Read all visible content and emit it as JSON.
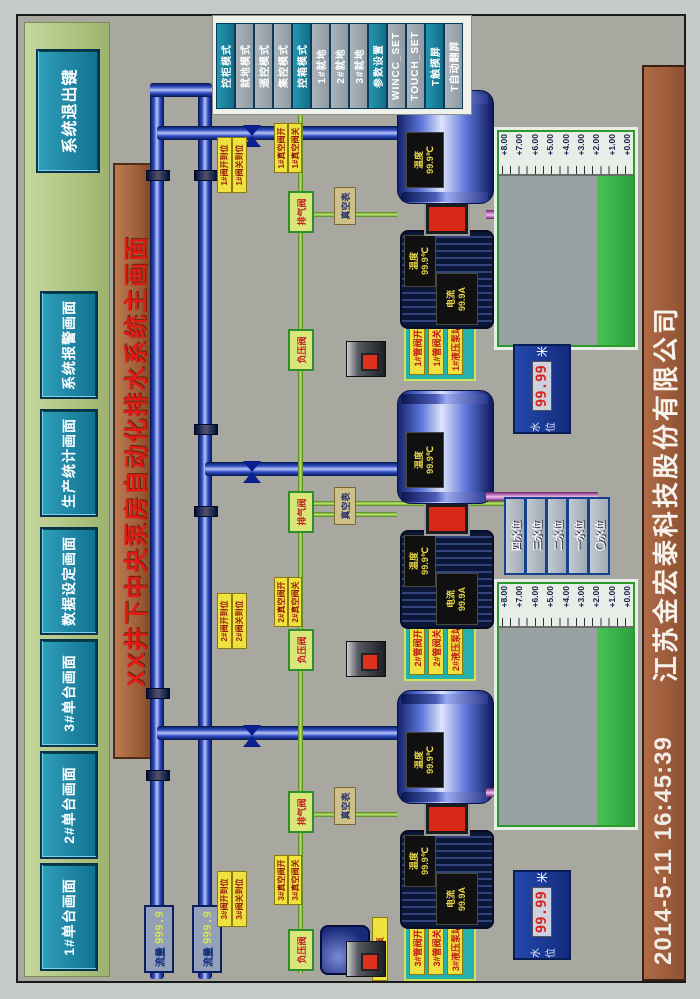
{
  "header": {
    "nav": [
      {
        "label": "1#单台画面"
      },
      {
        "label": "2#单台画面"
      },
      {
        "label": "3#单台画面"
      },
      {
        "label": "数据设定画面"
      },
      {
        "label": "生产统计画面"
      },
      {
        "label": "系统报警画面"
      }
    ],
    "exit_label": "系统退出键"
  },
  "title": "XX井下中央泵房自动化排水系统主画面",
  "mode_panel": {
    "buttons": [
      {
        "label": "控柜模式",
        "style": "teal"
      },
      {
        "label": "就地模式",
        "style": "gray"
      },
      {
        "label": "遥控模式",
        "style": "gray"
      },
      {
        "label": "集控模式",
        "style": "gray"
      },
      {
        "label": "控箱模式",
        "style": "teal"
      },
      {
        "label": "1#就地",
        "style": "gray"
      },
      {
        "label": "2#就地",
        "style": "gray"
      },
      {
        "label": "3#就地",
        "style": "gray"
      },
      {
        "label": "参数设置",
        "style": "teal"
      },
      {
        "label": "WINCC_SET",
        "style": "gray"
      },
      {
        "label": "TOUCH_SET",
        "style": "gray"
      },
      {
        "label": "T触摸屏",
        "style": "teal"
      },
      {
        "label": "T自动翻屏",
        "style": "gray"
      }
    ]
  },
  "flow_meters": [
    {
      "label": "流量",
      "value": "999.9"
    },
    {
      "label": "流量",
      "value": "999.9"
    }
  ],
  "vacuum": {
    "pump_label": "真空泵"
  },
  "units": [
    {
      "valve_open": "3#阀开到位",
      "valve_closed": "3#阀关到位",
      "vac_open": "3#真空阀开",
      "vac_closed": "3#真空阀关",
      "panel": [
        "3#管阀开",
        "3#管阀关",
        "3#液压泵站"
      ],
      "motor": {
        "current_label": "电流",
        "current": "99.9A",
        "temp_label": "温度",
        "temp": "99.9℃"
      },
      "pump": {
        "temp_label": "温度",
        "temp": "99.9℃"
      },
      "aux": {
        "vent": "排气阀",
        "vac_valve": "负压阀",
        "gauge": "真空表"
      }
    },
    {
      "valve_open": "2#阀开到位",
      "valve_closed": "2#阀关到位",
      "vac_open": "2#真空阀开",
      "vac_closed": "2#真空阀关",
      "panel": [
        "2#管阀开",
        "2#管阀关",
        "2#液压泵站"
      ],
      "motor": {
        "current_label": "电流",
        "current": "99.9A",
        "temp_label": "温度",
        "temp": "99.9℃"
      },
      "pump": {
        "temp_label": "温度",
        "temp": "99.9℃"
      },
      "aux": {
        "vent": "排气阀",
        "vac_valve": "负压阀",
        "gauge": "真空表"
      }
    },
    {
      "valve_open": "1#阀开到位",
      "valve_closed": "1#阀关到位",
      "vac_open": "1#真空阀开",
      "vac_closed": "1#真空阀关",
      "panel": [
        "1#管阀开",
        "1#管阀关",
        "1#液压泵站"
      ],
      "motor": {
        "current_label": "电流",
        "current": "99.9A",
        "temp_label": "温度",
        "temp": "99.9℃"
      },
      "pump": {
        "temp_label": "温度",
        "temp": "99.9℃"
      },
      "aux": {
        "vent": "排气阀",
        "vac_valve": "负压阀",
        "gauge": "真空表"
      }
    }
  ],
  "tanks": {
    "scale": [
      "+8.00",
      "+7.00",
      "+6.00",
      "+5.00",
      "+4.00",
      "+3.00",
      "+2.00",
      "+1.00",
      "+0.00"
    ],
    "level_displays": [
      {
        "label": "水位",
        "value": "99.99",
        "unit": "米"
      },
      {
        "label": "水位",
        "value": "99.99",
        "unit": "米"
      }
    ]
  },
  "level_buttons": [
    {
      "label": "四水位"
    },
    {
      "label": "三水位"
    },
    {
      "label": "二水位"
    },
    {
      "label": "一水位"
    },
    {
      "label": "〇水位"
    }
  ],
  "footer": {
    "datetime": "2014-5-11  16:45:39",
    "company": "江苏金宏泰科技股份有限公司"
  },
  "colors": {
    "button_teal": "#1c87a0",
    "bar_green": "#aec37f",
    "bar_brown": "#9a5a35",
    "title_red": "#e01a14",
    "pipe_blue": "#2e4cc4",
    "water_green": "#35b34a",
    "led_red": "#e02020",
    "label_yellow": "#efe23e"
  }
}
